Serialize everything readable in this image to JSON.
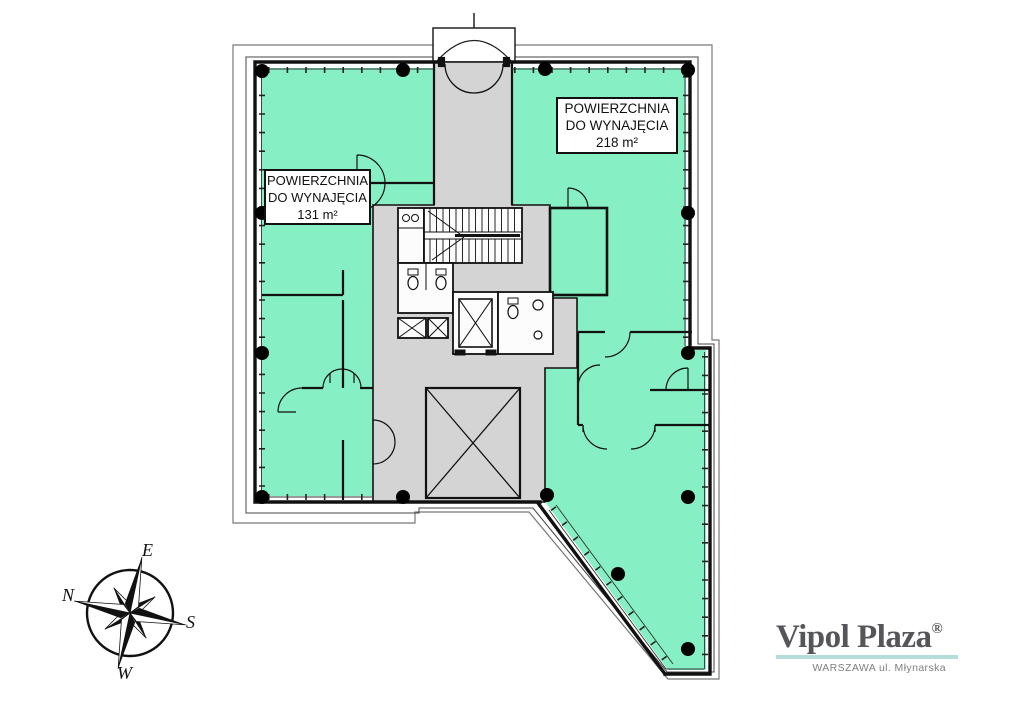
{
  "plan": {
    "area_labels": [
      {
        "id": "right",
        "lines": [
          "POWIERZCHNIA",
          "DO WYNAJĘCIA",
          "218 m²"
        ]
      },
      {
        "id": "left",
        "lines": [
          "POWIERZCHNIA",
          "DO WYNAJĘCIA",
          "131 m²"
        ]
      }
    ],
    "colors": {
      "rentable_green": "#86EFC3",
      "core_gray": "#D4D4D4",
      "wall": "#111111",
      "outline": "#555555"
    }
  },
  "compass": {
    "top": "E",
    "left": "N",
    "right": "S",
    "bottom": "W"
  },
  "logo": {
    "brand": "Vipol Plaza",
    "registered": "®",
    "tagline": "WARSZAWA ul. Młynarska",
    "underline_color": "#b5dedb"
  }
}
